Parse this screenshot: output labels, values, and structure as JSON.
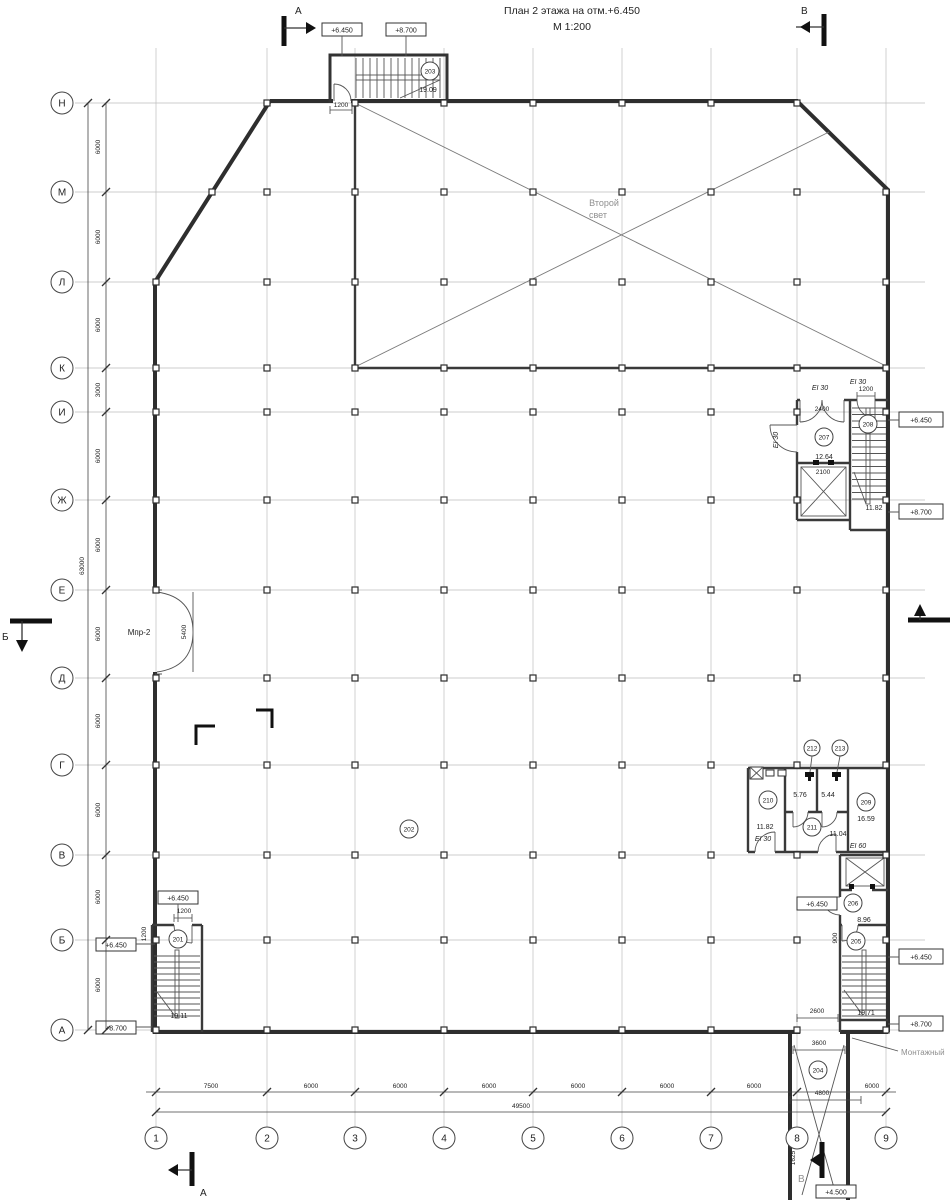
{
  "title": {
    "line1": "План 2 этажа на отм.+6.450",
    "line2": "М 1:200"
  },
  "axes": {
    "rows": [
      "Н",
      "М",
      "Л",
      "К",
      "И",
      "Ж",
      "Е",
      "Д",
      "Г",
      "В",
      "Б",
      "А"
    ],
    "cols": [
      "1",
      "2",
      "3",
      "4",
      "5",
      "6",
      "7",
      "8",
      "9"
    ]
  },
  "dims": {
    "left": [
      "6000",
      "6000",
      "6000",
      "3000",
      "6000",
      "6000",
      "6000",
      "6000",
      "6000",
      "6000",
      "6000"
    ],
    "left_total": "63000",
    "bottom": [
      "7500",
      "6000",
      "6000",
      "6000",
      "6000",
      "6000",
      "6000",
      "6000"
    ],
    "bottom_total": "49500",
    "d1200": "1200",
    "d2400": "2400",
    "d2100": "2100",
    "d5400": "5400",
    "d900": "900",
    "d2600": "2600",
    "d3600": "3600",
    "d4800": "4800",
    "d1625": "1625"
  },
  "rooms": {
    "r201": {
      "num": "201",
      "area": "19.11"
    },
    "r202": {
      "num": "202"
    },
    "r203": {
      "num": "203",
      "area": "19.09"
    },
    "r204": {
      "num": "204"
    },
    "r205": {
      "num": "205",
      "area": "19.71"
    },
    "r206": {
      "num": "206",
      "area": "8.96"
    },
    "r207": {
      "num": "207",
      "area": "12.64"
    },
    "r208": {
      "num": "208",
      "area": "11.82"
    },
    "r209": {
      "num": "209",
      "area": "16.59"
    },
    "r210": {
      "num": "210",
      "area": "11.82"
    },
    "r211": {
      "num": "211",
      "area": "11.04"
    },
    "r212": {
      "num": "212",
      "area": "5.76"
    },
    "r213": {
      "num": "213",
      "area": "5.44"
    }
  },
  "elev": {
    "e6450": "+6.450",
    "e8700": "+8.700",
    "e4500": "+4.500"
  },
  "fire": {
    "ei30": "EI 30",
    "ei60": "EI 60"
  },
  "labels": {
    "void1": "Второй",
    "void2": "свет",
    "gate": "Мпр-2",
    "montage": "Монтажный",
    "sec_a": "А",
    "sec_b": "Б",
    "sec_v": "В"
  }
}
